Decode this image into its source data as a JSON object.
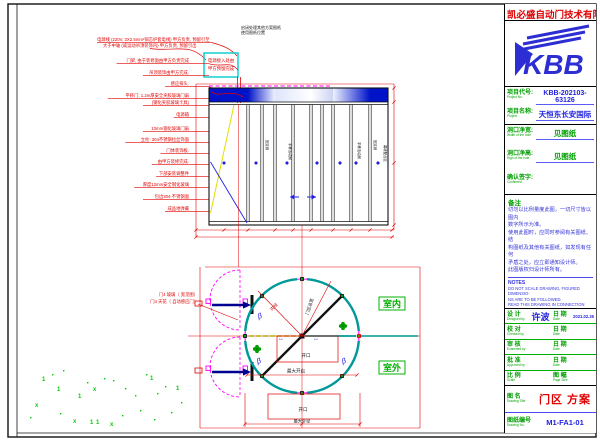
{
  "title_block": {
    "company": "凯必盛自动门技术有限公司",
    "logo_text": "KBB",
    "fields": {
      "project_no_label": "项目代号:",
      "project_no_en": "Project No.",
      "project_no": "KBB-202103-63126",
      "project_name_label": "项目名称:",
      "project_name_en": "Project",
      "project_name": "天恒东长安国际",
      "width_label": "洞口净宽:",
      "width_en": "Width of the hole",
      "width": "见图纸",
      "height_label": "洞口净高:",
      "height_en": "High of the hole",
      "height": "见图纸",
      "confirm_label": "确认签字:",
      "confirm_en": "Confirmed"
    },
    "notes_cn": {
      "title": "备注",
      "lines": "切勿以比例量度此图，一切尺寸皆以图内\n数字所示为准。\n使用此图时，应同时参阅有关图纸、结\n构图纸及其他有关图纸，如发现有任何\n矛盾之处，应立即通知设计师。\n此图版权归设计师所有。"
    },
    "notes_en": {
      "title": "NOTES",
      "lines": "DO NOT SCALE DRAWING, FIGURED DIMENSIO-\nNS ARE TO BE FOLLOWED.\nREAD THIS DRAWING IN CONNECTION WITH G-\nENERAL PLANS, STRUCTURAL PLANS AND OTH-\nER RELATED DRAWINGS. THE ARCHITECT SHA-\nLL BE NOTIFIED IMMEDIATELY OF ANY DISC-\nREPANCY FOUND THEREIN. COPYRIGHT OF TH-\nIS DRAWING RESERVED BY DESIGNER."
    },
    "signatures": [
      {
        "l": "设  计",
        "en": "Designed by",
        "v": "许波",
        "dl": "日  期",
        "den": "Date",
        "dv": "2021.02.26"
      },
      {
        "l": "校  对",
        "en": "Checked by",
        "v": "",
        "dl": "日  期",
        "den": "Date",
        "dv": ""
      },
      {
        "l": "审  核",
        "en": "Examined by",
        "v": "",
        "dl": "日  期",
        "den": "Date",
        "dv": ""
      },
      {
        "l": "批  准",
        "en": "Approved by",
        "v": "",
        "dl": "日  期",
        "den": "Date",
        "dv": ""
      },
      {
        "l": "比  例",
        "en": "Scale",
        "v": "",
        "dl": "图  幅",
        "den": "Page Size",
        "dv": ""
      }
    ],
    "drawing_title": {
      "label": "图  名",
      "en": "Drawing Title",
      "value": "门区  方案"
    },
    "drawing_no": {
      "label": "图纸编号",
      "en": "Drawing No.",
      "value": "M1-FA1-01"
    }
  },
  "drawing": {
    "top_note": [
      "启闭处理其他方案图纸",
      "使用图纸位置"
    ],
    "power_note": [
      "电源线 (220V, 3X2.5mm²铜芯护套电线) 甲方负责, 预留引至",
      "大于中轴 (或运动吊顶装饰内) 甲方负责, 预留引出"
    ],
    "cyan_box": [
      "电源接入处由",
      "甲方预留完成"
    ],
    "left_labels": [
      {
        "y": 62,
        "t": "门梁, 由于装修面由甲方负责完成"
      },
      {
        "y": 74,
        "t": "吊顶装饰由甲方完成."
      },
      {
        "y": 85,
        "t": "感应探头."
      },
      {
        "y": 97,
        "t": "平移门: 1.2m厚安全夹胶玻璃门扇"
      },
      {
        "y": 104,
        "t": "(钢化夹胶玻璃卡具)"
      },
      {
        "y": 116,
        "t": "电源箱"
      },
      {
        "y": 130,
        "t": "10mm钢化玻璃门扇"
      },
      {
        "y": 141,
        "t": "立柱: 304不锈钢拉丝饰面"
      },
      {
        "y": 152,
        "t": "门体装饰板."
      },
      {
        "y": 163,
        "t": "由甲方装修完成."
      },
      {
        "y": 175,
        "t": "下部安装调整件"
      },
      {
        "y": 186,
        "t": "厚度12mm安全钢化玻璃"
      },
      {
        "y": 198,
        "t": "包边304-不锈钢面"
      },
      {
        "y": 210,
        "t": "成品地弹簧"
      }
    ],
    "elevation": {
      "vertical_labels": [
        {
          "x": 266,
          "y": 140,
          "t": "固定扇"
        },
        {
          "x": 289,
          "y": 143,
          "t": "平移活动扇"
        },
        {
          "x": 358,
          "y": 142,
          "t": "平移活动扇"
        },
        {
          "x": 374,
          "y": 140,
          "t": "固定扇"
        },
        {
          "x": 384,
          "y": 145,
          "t": "幕墙配合区"
        }
      ],
      "mullions": [
        248,
        262,
        275,
        293,
        311,
        322,
        333,
        351,
        370
      ],
      "diamonds": [
        224,
        256,
        287,
        317,
        340,
        356,
        378
      ]
    },
    "plan": {
      "inner_dia": "内径",
      "total_width": "门区总宽",
      "opening1": "开口",
      "max_open": "最大开启",
      "opening2": "开口",
      "max_outer": "最大外径",
      "room_in": "室内",
      "room_out": "室外",
      "beta_symbol": "β",
      "door_labels": [
        "门4 玻璃（ 宽见图）",
        "门4 天花（ 自动感应门）"
      ],
      "scatter": [
        [
          42,
          381,
          "1"
        ],
        [
          57,
          391,
          "1"
        ],
        [
          78,
          398,
          "1"
        ],
        [
          93,
          391,
          "x"
        ],
        [
          35,
          407,
          "x"
        ],
        [
          73,
          423,
          "x"
        ],
        [
          90,
          424,
          "1"
        ],
        [
          96,
          424,
          "1"
        ],
        [
          110,
          426,
          "x"
        ],
        [
          63,
          370,
          "."
        ],
        [
          87,
          382,
          "."
        ],
        [
          113,
          380,
          "."
        ],
        [
          125,
          388,
          "."
        ],
        [
          135,
          395,
          "."
        ],
        [
          150,
          380,
          "1"
        ],
        [
          157,
          393,
          "."
        ],
        [
          165,
          386,
          "."
        ],
        [
          176,
          390,
          "1"
        ],
        [
          52,
          374,
          "."
        ],
        [
          104,
          378,
          "."
        ],
        [
          122,
          415,
          "."
        ],
        [
          140,
          410,
          "."
        ],
        [
          154,
          419,
          "."
        ],
        [
          30,
          417,
          "."
        ],
        [
          171,
          412,
          "."
        ],
        [
          181,
          402,
          "."
        ],
        [
          60,
          413,
          "."
        ],
        [
          146,
          374,
          "."
        ]
      ]
    },
    "dim_ticks": [
      [
        196,
        230
      ],
      [
        224,
        230
      ],
      [
        248,
        230
      ],
      [
        275,
        230
      ],
      [
        293,
        230
      ],
      [
        311,
        230
      ],
      [
        333,
        230
      ],
      [
        351,
        230
      ],
      [
        370,
        230
      ],
      [
        392,
        230
      ],
      [
        196,
        237
      ],
      [
        392,
        237
      ],
      [
        394,
        88
      ],
      [
        394,
        102
      ],
      [
        394,
        163
      ],
      [
        394,
        225
      ],
      [
        247,
        375
      ],
      [
        357,
        375
      ],
      [
        245,
        424
      ],
      [
        302,
        424
      ],
      [
        360,
        424
      ]
    ],
    "colors": {
      "annotation_red": "#e00000",
      "band_blue": "#0013c8",
      "magenta": "#ff00ff",
      "teal": "#009898",
      "green": "#00a000"
    }
  }
}
